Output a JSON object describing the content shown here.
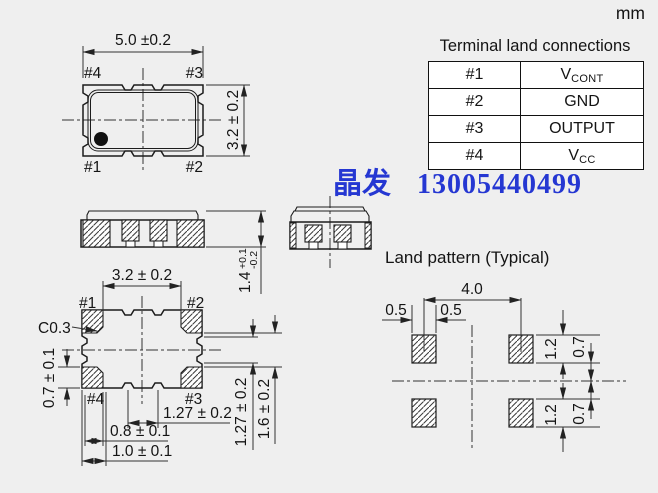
{
  "unit": "mm",
  "watermark": {
    "cn": "晶发",
    "phone": "13005440499",
    "color": "#2537d2"
  },
  "table": {
    "title": "Terminal land connections",
    "rows": [
      {
        "pin": "#1",
        "main": "V",
        "sub": "CONT"
      },
      {
        "pin": "#2",
        "main": "GND",
        "sub": ""
      },
      {
        "pin": "#3",
        "main": "OUTPUT",
        "sub": ""
      },
      {
        "pin": "#4",
        "main": "V",
        "sub": "CC"
      }
    ]
  },
  "top_view": {
    "dim_width": "5.0 ±0.2",
    "dim_height": "3.2 ± 0.2",
    "pin_tl": "#4",
    "pin_tr": "#3",
    "pin_bl": "#1",
    "pin_br": "#2"
  },
  "side_view": {
    "dim_base": "1.4",
    "dim_plus": "+0.1",
    "dim_minus": "-0.2"
  },
  "bottom_view": {
    "dim_width": "3.2 ± 0.2",
    "chamfer": "C0.3",
    "dim_pad_h": "0.7 ± 0.1",
    "pin_tl": "#1",
    "pin_tr": "#2",
    "pin_bl": "#4",
    "pin_br": "#3",
    "dim_pitch": "1.27 ± 0.2",
    "dim_08": "0.8 ± 0.1",
    "dim_10": "1.0 ± 0.1",
    "dim_right_inner": "1.27 ± 0.2",
    "dim_right_outer": "1.6 ± 0.2"
  },
  "land_pattern": {
    "title": "Land pattern (Typical)",
    "dim_pitch": "4.0",
    "dim_half_left": "0.5",
    "dim_half_right": "0.5",
    "dim_pad_h_top": "1.2",
    "dim_gap_top": "0.7",
    "dim_gap_bottom": "0.7",
    "dim_pad_h_bottom": "1.2"
  }
}
